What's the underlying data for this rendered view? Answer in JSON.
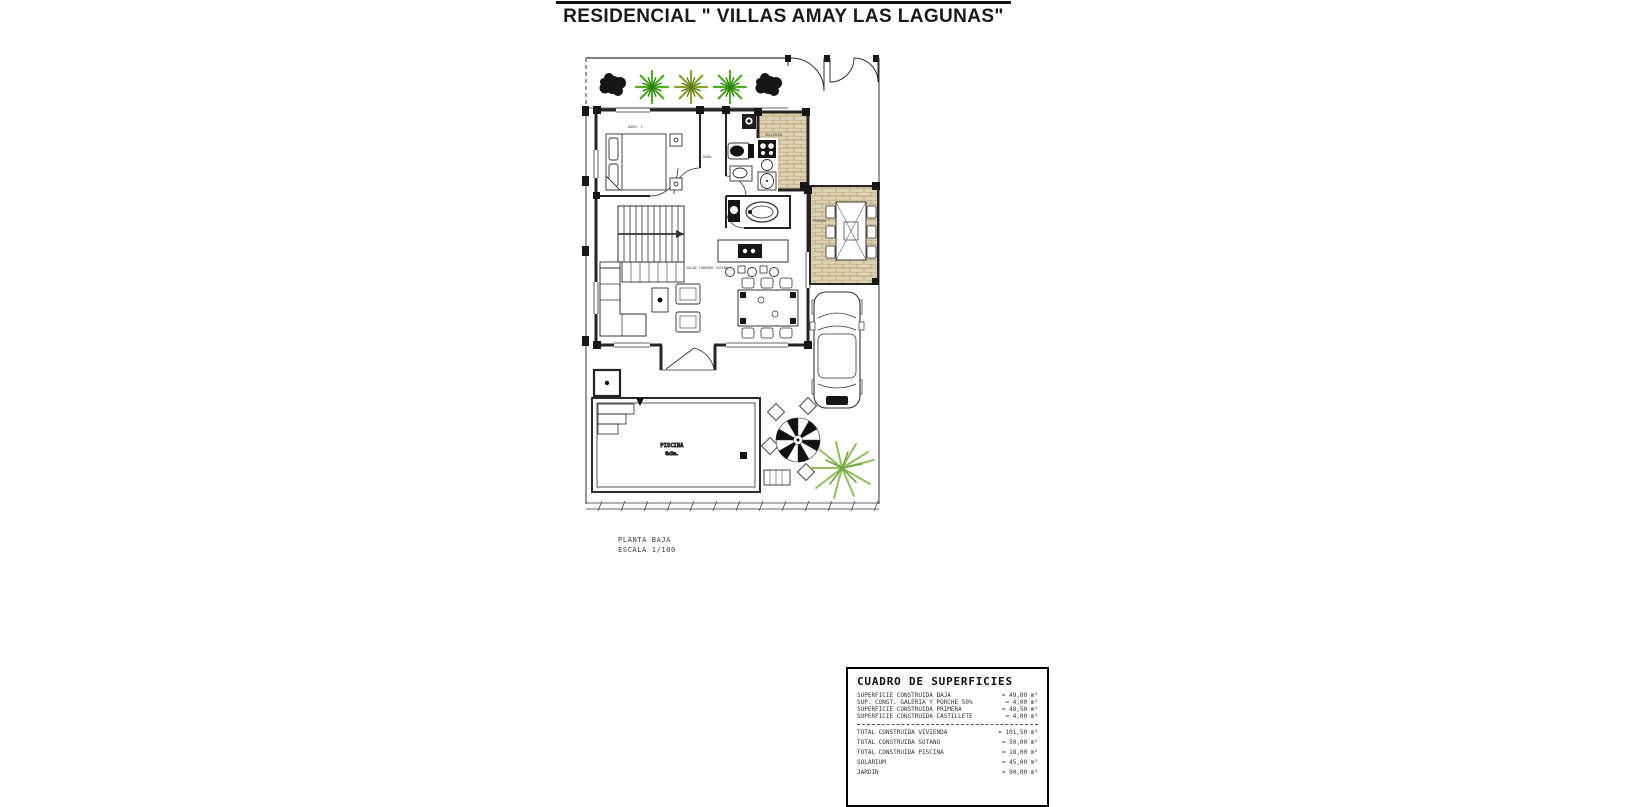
{
  "page": {
    "title": "RESIDENCIAL \" VILLAS AMAY LAS LAGUNAS\""
  },
  "plan": {
    "caption": {
      "line1": "PLANTA BAJA",
      "line2": "ESCALA 1/100"
    },
    "labels": {
      "bedroom": "DORM. 1",
      "bathroom": "BAÑO",
      "living": "SALON COMEDOR COCINA",
      "galeria": "GALERIA",
      "porche": "PORCHE",
      "pool_name": "PISCINA",
      "pool_size": "6x3m."
    }
  },
  "areas_table": {
    "title": "CUADRO DE SUPERFICIES",
    "rows": [
      {
        "label": "SUPERFICIE CONSTRUIDA BAJA",
        "value": "= 49,00 m²"
      },
      {
        "label": "SUP. CONST. GALERIA Y PORCHE 50%",
        "value": "= 4,00 m²"
      },
      {
        "label": "SUPERFICIE CONSTRUIDA PRIMERA",
        "value": "= 48,50 m²"
      },
      {
        "label": "SUPERFICIE CONSTRUIDA CASTILLETE",
        "value": "= 4,00 m²"
      }
    ],
    "totals": [
      {
        "label": "TOTAL CONSTRUIDA VIVIENDA",
        "value": "= 101,50 m²"
      },
      {
        "label": "TOTAL CONSTRUIDA SOTANO",
        "value": "= 50,00 m²"
      },
      {
        "label": "TOTAL CONSTRUIDA PISCINA",
        "value": "= 18,00 m²"
      },
      {
        "label": "SOLARIUM",
        "value": "= 45,00 m²"
      },
      {
        "label": "JARDIN",
        "value": "= 90,00 m²"
      }
    ]
  },
  "colors": {
    "line": "#2a2a2a",
    "wall": "#242424",
    "brick_fill": "#ddd1b2",
    "brick_line": "#b19e75",
    "plant_green": "#4fae22",
    "plant_dark_green": "#2e7a12",
    "plant_olive": "#8aa32e",
    "palm_light": "#8fbf5f",
    "tree_dark": "#161616",
    "label_red": "#9a4a3a"
  }
}
